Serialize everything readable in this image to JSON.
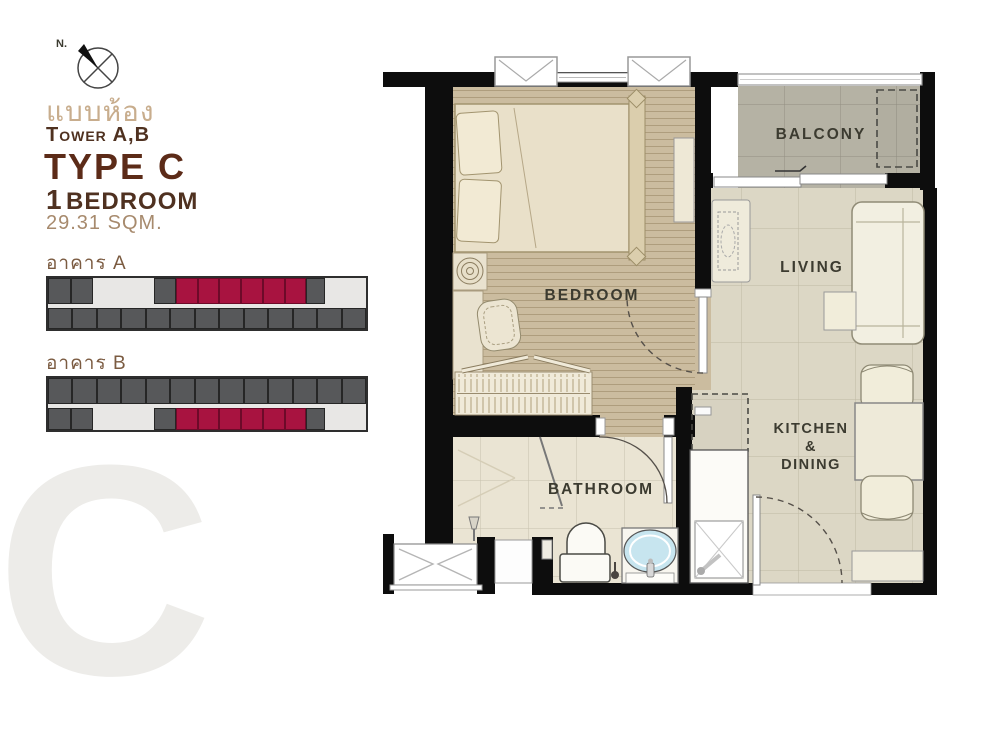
{
  "header": {
    "compass_label": "N.",
    "room_type_thai": "แบบห้อง",
    "tower": "Tower A,B",
    "type_name": "TYPE C",
    "bedroom_num": "1",
    "bedroom_word": "BEDROOM",
    "area": "29.31 SQM."
  },
  "buildings": [
    {
      "label": "อาคาร A",
      "rows": [
        {
          "h": 26,
          "cells": [
            [
              "dark",
              7.3
            ],
            [
              "dark",
              7.3
            ],
            [
              "gap",
              21.5
            ],
            [
              "dark",
              7
            ],
            [
              "red",
              7
            ],
            [
              "red",
              7
            ],
            [
              "red",
              7
            ],
            [
              "red",
              7
            ],
            [
              "red",
              7
            ],
            [
              "red",
              7
            ],
            [
              "dark",
              6
            ],
            [
              "gap",
              14.4
            ]
          ]
        },
        {
          "h": 21,
          "cells": [
            [
              "dark",
              1
            ],
            [
              "dark",
              1
            ],
            [
              "dark",
              1
            ],
            [
              "dark",
              1
            ],
            [
              "dark",
              1
            ],
            [
              "dark",
              1
            ],
            [
              "dark",
              1
            ],
            [
              "dark",
              1
            ],
            [
              "dark",
              1
            ],
            [
              "dark",
              1
            ],
            [
              "dark",
              1
            ],
            [
              "dark",
              1
            ],
            [
              "dark",
              1
            ]
          ]
        }
      ]
    },
    {
      "label": "อาคาร B",
      "rows": [
        {
          "h": 26,
          "cells": [
            [
              "dark",
              1
            ],
            [
              "dark",
              1
            ],
            [
              "dark",
              1
            ],
            [
              "dark",
              1
            ],
            [
              "dark",
              1
            ],
            [
              "dark",
              1
            ],
            [
              "dark",
              1
            ],
            [
              "dark",
              1
            ],
            [
              "dark",
              1
            ],
            [
              "dark",
              1
            ],
            [
              "dark",
              1
            ],
            [
              "dark",
              1
            ],
            [
              "dark",
              1
            ]
          ]
        },
        {
          "h": 22,
          "cells": [
            [
              "dark",
              7.3
            ],
            [
              "dark",
              7.3
            ],
            [
              "gap",
              21.5
            ],
            [
              "dark",
              7
            ],
            [
              "red",
              7
            ],
            [
              "red",
              7
            ],
            [
              "red",
              7
            ],
            [
              "red",
              7
            ],
            [
              "red",
              7
            ],
            [
              "red",
              7
            ],
            [
              "dark",
              6
            ],
            [
              "gap",
              14.4
            ]
          ]
        }
      ]
    }
  ],
  "floorplan": {
    "rooms": {
      "bedroom": "BEDROOM",
      "balcony": "BALCONY",
      "living": "LIVING",
      "kitchen1": "KITCHEN",
      "kitchen2": "&",
      "kitchen3": "DINING",
      "bathroom": "BATHROOM"
    }
  },
  "watermark": "C",
  "colors": {
    "unit_red": "#a81340",
    "unit_dark": "#57585a",
    "wall": "#0d0d0d",
    "wood_floor": "#cbbc9f",
    "tile_living": "#dcd7c5",
    "tile_balcony": "#b5b2a4",
    "tile_bath": "#eae4d3",
    "accent_brown": "#5c2b18"
  }
}
